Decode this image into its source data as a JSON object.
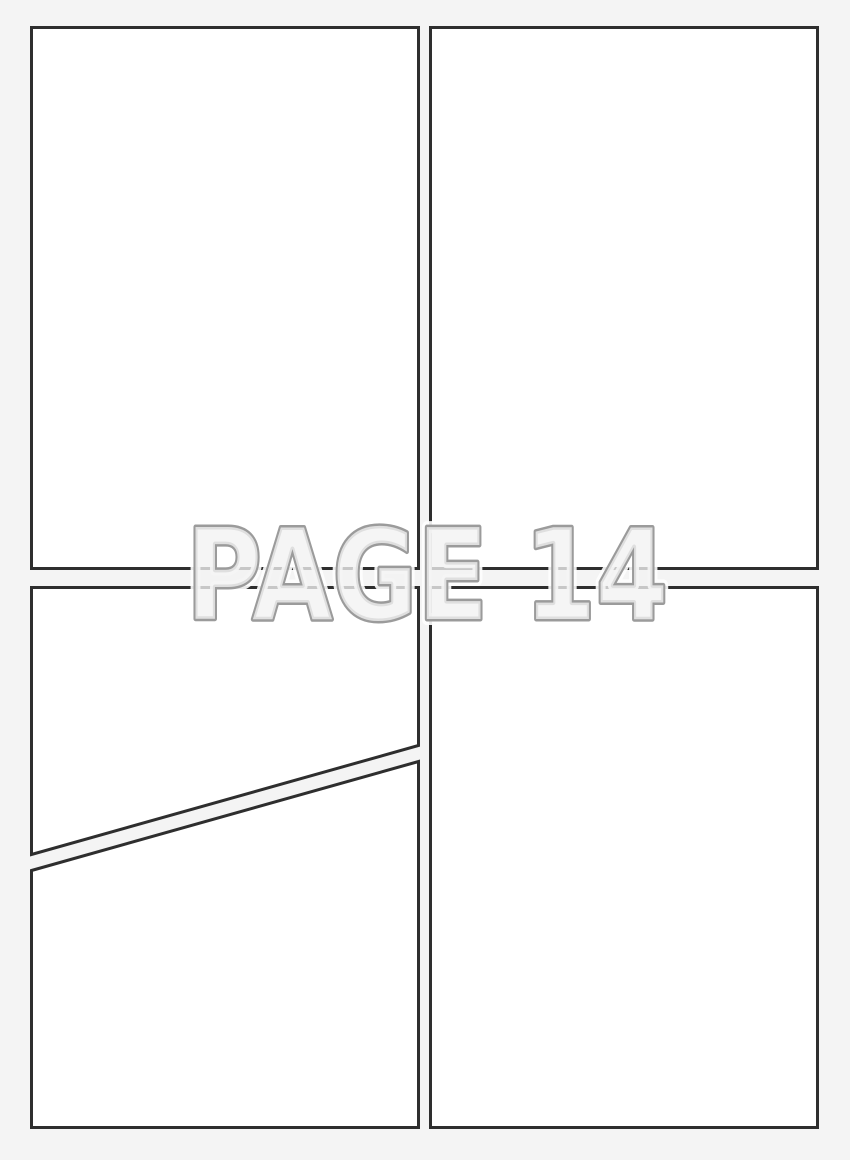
{
  "page": {
    "kind": "blank-comic-page-template",
    "panel_count": 5
  },
  "watermark": {
    "text": "PAGE 14"
  },
  "colors": {
    "bg": "#f4f4f4",
    "panel_fill": "#ffffff",
    "panel_border": "#2e2e2e",
    "wm_halo": "#ffffff",
    "wm_stroke": "#9b9b9b",
    "wm_fill": "#f2f2f2"
  }
}
